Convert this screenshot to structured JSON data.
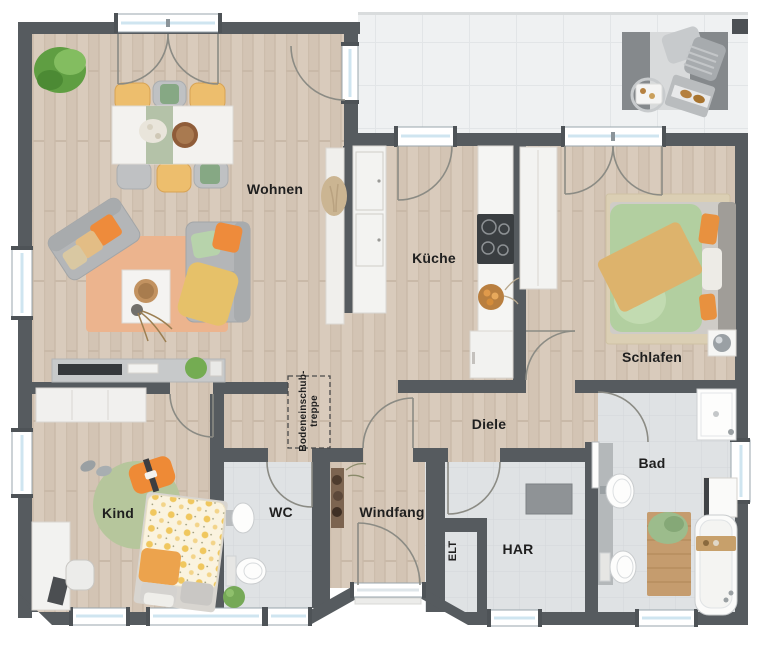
{
  "rooms": {
    "wohnen": {
      "label": "Wohnen"
    },
    "kueche": {
      "label": "Küche"
    },
    "schlafen": {
      "label": "Schlafen"
    },
    "diele": {
      "label": "Diele"
    },
    "kind": {
      "label": "Kind"
    },
    "wc": {
      "label": "WC"
    },
    "windfang": {
      "label": "Windfang"
    },
    "har": {
      "label": "HAR"
    },
    "bad": {
      "label": "Bad"
    },
    "elt": {
      "label": "ELT"
    }
  },
  "annotations": {
    "attic_stair": {
      "line1": "Bodeneinschub-",
      "line2": "treppe"
    }
  },
  "palette": {
    "wall": "#565b5f",
    "wood_floor": "#d8cabb",
    "tile_floor": "#dfe2e4",
    "terrace_floor": "#eff1f2",
    "window_glass": "#cfe5f0",
    "accent_orange": "#ee8b3b",
    "accent_green": "#b2cfa0",
    "accent_yellow": "#edbe6d"
  }
}
